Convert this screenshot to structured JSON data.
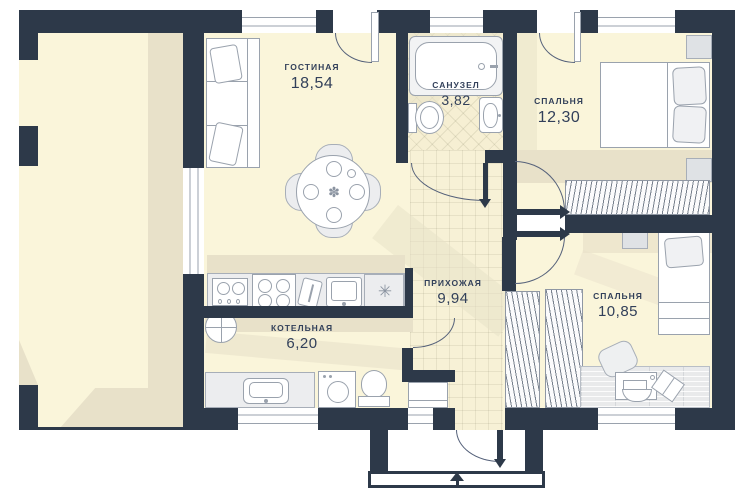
{
  "plan": {
    "title": "floor-plan",
    "rooms": [
      {
        "id": "living",
        "label": "ГОСТИНАЯ",
        "area": "18,54"
      },
      {
        "id": "bathroom",
        "label": "САНУЗЕЛ",
        "area": "3,82"
      },
      {
        "id": "bedroom1",
        "label": "СПАЛЬНЯ",
        "area": "12,30"
      },
      {
        "id": "hall",
        "label": "ПРИХОЖАЯ",
        "area": "9,94"
      },
      {
        "id": "boiler",
        "label": "КОТЕЛЬНАЯ",
        "area": "6,20"
      },
      {
        "id": "bedroom2",
        "label": "СПАЛЬНЯ",
        "area": "10,85"
      }
    ],
    "icons": {
      "flower": "✽",
      "vent": "✳"
    },
    "colors": {
      "wall": "#2d3949",
      "floor": "#faf5da",
      "shade": "#e8e1c9",
      "ink": "#32405a",
      "line": "#9aa2ad",
      "arc": "#55617a"
    }
  }
}
